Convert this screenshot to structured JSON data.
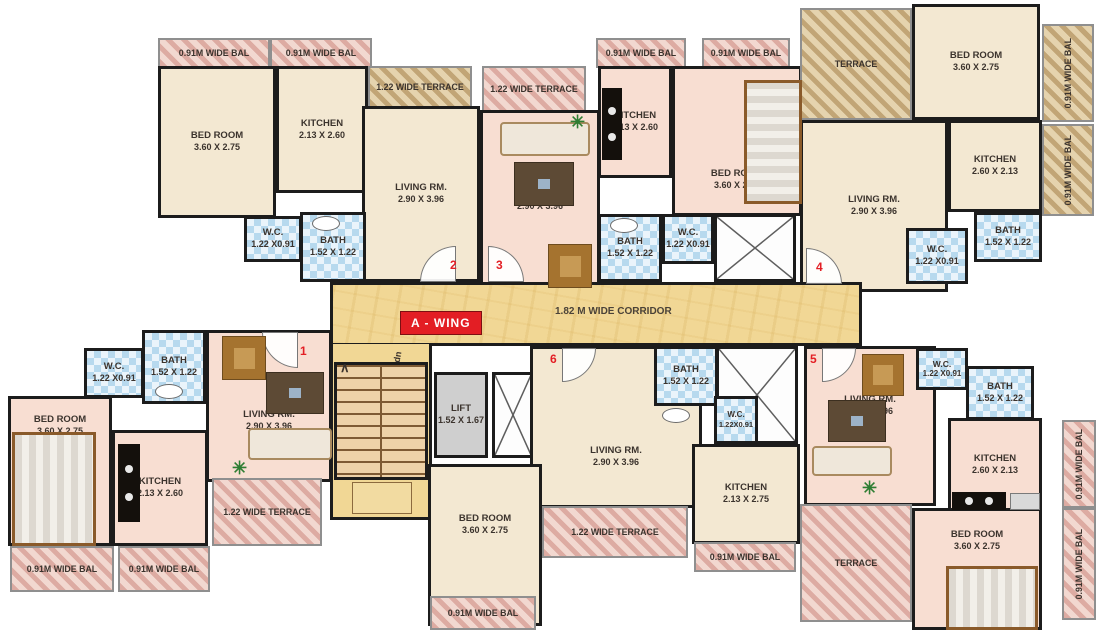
{
  "core": {
    "wing_label": "A - WING",
    "corridor_label": "1.82 M WIDE CORRIDOR",
    "lift": {
      "name": "LIFT",
      "dims": "1.52 X 1.67"
    },
    "stair_note": "dn"
  },
  "colors": {
    "accent_red": "#e31e24",
    "corridor_yellow": "#f1d795",
    "wall_black": "#1c1c1c",
    "floor_cream": "#f3e8d2",
    "floor_pink": "#f8ded2",
    "wet_blue": "#eaf4fb",
    "hatch_tan": "#e5d3ae",
    "hatch_pink": "#f2d8d0"
  },
  "flats": {
    "f1": {
      "number": "1",
      "bedroom": {
        "name": "BED ROOM",
        "dims": "3.60 X 2.75"
      },
      "kitchen": {
        "name": "KITCHEN",
        "dims": "2.13 X 2.60"
      },
      "living": {
        "name": "LIVING RM.",
        "dims": "2.90 X 3.96"
      },
      "bath": {
        "name": "BATH",
        "dims": "1.52 X 1.22"
      },
      "wc": {
        "name": "W.C.",
        "dims": "1.22 X0.91"
      },
      "terrace": "1.22 WIDE TERRACE",
      "balcony1": "0.91M WIDE BAL",
      "balcony2": "0.91M WIDE BAL"
    },
    "f2": {
      "number": "2",
      "bedroom": {
        "name": "BED ROOM",
        "dims": "3.60 X 2.75"
      },
      "kitchen": {
        "name": "KITCHEN",
        "dims": "2.13 X 2.60"
      },
      "living": {
        "name": "LIVING RM.",
        "dims": "2.90 X 3.96"
      },
      "bath": {
        "name": "BATH",
        "dims": "1.52 X 1.22"
      },
      "wc": {
        "name": "W.C.",
        "dims": "1.22 X0.91"
      },
      "terrace": "1.22 WIDE TERRACE",
      "balcony1": "0.91M WIDE BAL",
      "balcony2": "0.91M WIDE BAL"
    },
    "f3": {
      "number": "3",
      "bedroom": {
        "name": "BED ROOM",
        "dims": "3.60 X 2.75"
      },
      "kitchen": {
        "name": "KITCHEN",
        "dims": "2.13 X 2.60"
      },
      "living": {
        "name": "LIVING RM.",
        "dims": "2.90 X 3.96"
      },
      "bath": {
        "name": "BATH",
        "dims": "1.52 X 1.22"
      },
      "wc": {
        "name": "W.C.",
        "dims": "1.22 X0.91"
      },
      "terrace": "1.22 WIDE TERRACE",
      "balcony1": "0.91M WIDE BAL",
      "balcony2": "0.91M WIDE BAL"
    },
    "f4": {
      "number": "4",
      "bedroom": {
        "name": "BED ROOM",
        "dims": "3.60 X 2.75"
      },
      "kitchen": {
        "name": "KITCHEN",
        "dims": "2.60 X 2.13"
      },
      "living": {
        "name": "LIVING RM.",
        "dims": "2.90 X 3.96"
      },
      "bath": {
        "name": "BATH",
        "dims": "1.52 X 1.22"
      },
      "wc": {
        "name": "W.C.",
        "dims": "1.22 X0.91"
      },
      "terrace": "TERRACE",
      "balcony1": "0.91M WIDE BAL",
      "balcony2": "0.91M WIDE BAL"
    },
    "f5": {
      "number": "5",
      "bedroom": {
        "name": "BED ROOM",
        "dims": "3.60 X 2.75"
      },
      "kitchen": {
        "name": "KITCHEN",
        "dims": "2.60 X 2.13"
      },
      "living": {
        "name": "LIVING RM.",
        "dims": "2.90 X 3.96"
      },
      "bath": {
        "name": "BATH",
        "dims": "1.52 X 1.22"
      },
      "wc": {
        "name": "W.C.",
        "dims": "1.22 X0.91"
      },
      "terrace": "TERRACE",
      "balcony1": "0.91M WIDE BAL",
      "balcony2": "0.91M WIDE BAL"
    },
    "f6": {
      "number": "6",
      "bedroom": {
        "name": "BED ROOM",
        "dims": "3.60 X 2.75"
      },
      "kitchen": {
        "name": "KITCHEN",
        "dims": "2.13 X 2.75"
      },
      "living": {
        "name": "LIVING RM.",
        "dims": "2.90 X 3.96"
      },
      "bath": {
        "name": "BATH",
        "dims": "1.52 X 1.22"
      },
      "wc": {
        "name": "W.C.",
        "dims": "1.22X0.91"
      },
      "terrace": "1.22 WIDE TERRACE",
      "balcony1": "0.91M WIDE BAL",
      "balcony2": "0.91M WIDE BAL"
    }
  }
}
